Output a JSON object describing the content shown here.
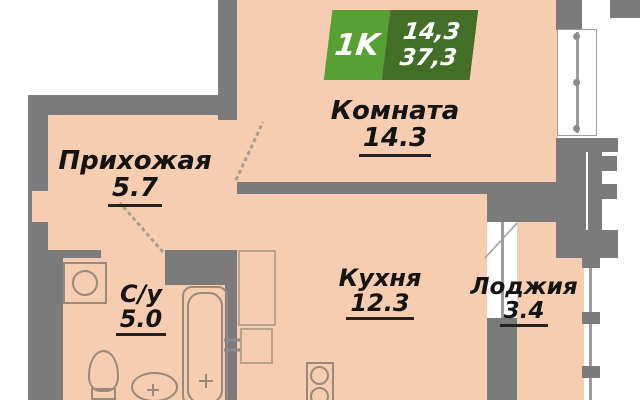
{
  "plan": {
    "type": "apartment-floor-plan",
    "badge": {
      "rooms_label": "1K",
      "living_area": "14,3",
      "total_area": "37,3"
    },
    "rooms": [
      {
        "name": "Комната",
        "area": "14.3"
      },
      {
        "name": "Прихожая",
        "area": "5.7"
      },
      {
        "name": "Кухня",
        "area": "12.3"
      },
      {
        "name": "Лоджия",
        "area": "3.4"
      },
      {
        "name": "С/у",
        "area": "5.0"
      }
    ],
    "fixtures": [
      "washing-machine-icon",
      "toilet-icon",
      "sink-icon",
      "bathtub-icon",
      "stove-icon",
      "kitchen-sink-icon",
      "vent-shaft",
      "window",
      "balcony-door"
    ],
    "colors": {
      "floor": "#f6cdb1",
      "walls": "#7b7b7b",
      "outside": "#ffffff",
      "badge_light_green": "#57a033",
      "badge_dark_green": "#426e28",
      "label_text": "#141414"
    }
  }
}
